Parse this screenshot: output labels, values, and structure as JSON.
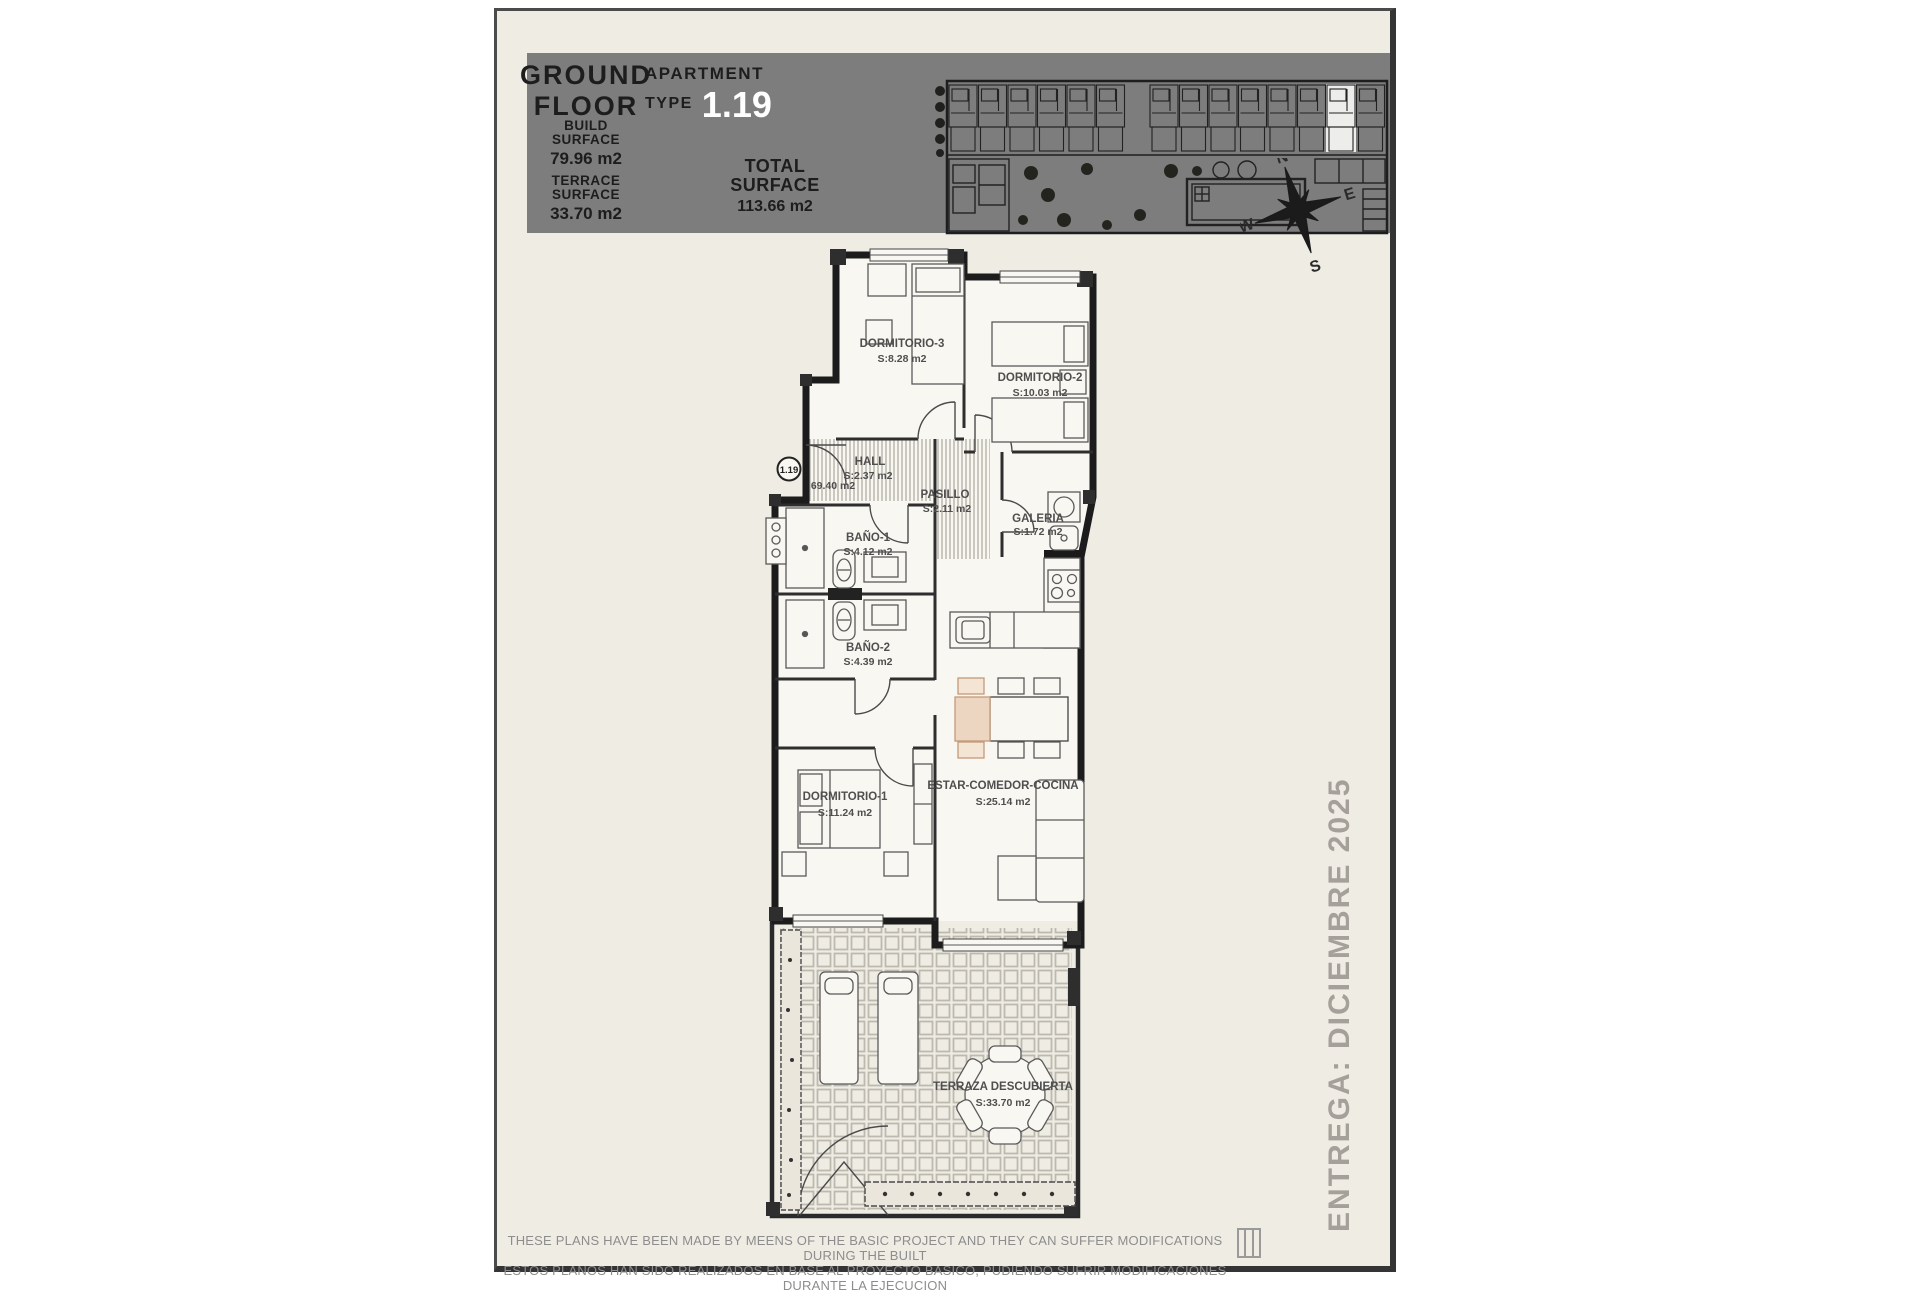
{
  "header": {
    "floor_line1": "GROUND",
    "floor_line2": "FLOOR",
    "build_label_1": "BUILD",
    "build_label_2": "SURFACE",
    "build_value": "79.96 m2",
    "terrace_label_1": "TERRACE",
    "terrace_label_2": "SURFACE",
    "terrace_value": "33.70 m2",
    "apartment_label": "APARTMENT",
    "type_label": "TYPE",
    "apartment_number": "1.19",
    "total_label_1": "TOTAL",
    "total_label_2": "SURFACE",
    "total_value": "113.66 m2"
  },
  "compass": {
    "n": "N",
    "e": "E",
    "s": "S",
    "w": "W"
  },
  "plan": {
    "unit_badge": "1.19",
    "useful_surface": "69.40 m2",
    "rooms": [
      {
        "name": "DORMITORIO-3",
        "area": "S:8.28 m2"
      },
      {
        "name": "DORMITORIO-2",
        "area": "S:10.03 m2"
      },
      {
        "name": "HALL",
        "area": "S:2.37 m2"
      },
      {
        "name": "PASILLO",
        "area": "S:2.11 m2"
      },
      {
        "name": "BAÑO-1",
        "area": "S:4.12 m2"
      },
      {
        "name": "GALERIA",
        "area": "S:1.72 m2"
      },
      {
        "name": "BAÑO-2",
        "area": "S:4.39 m2"
      },
      {
        "name": "DORMITORIO-1",
        "area": "S:11.24 m2"
      },
      {
        "name": "ESTAR-COMEDOR-COCINA",
        "area": "S:25.14 m2"
      },
      {
        "name": "TERRAZA DESCUBIERTA",
        "area": "S:33.70 m2"
      }
    ]
  },
  "site_plan": {
    "units_count": 14,
    "highlight_index": 12,
    "road_after_index": 5
  },
  "delivery_note": "ENTREGA: DICIEMBRE 2025",
  "disclaimer": {
    "line1": "THESE PLANS HAVE BEEN MADE BY MEENS OF THE BASIC PROJECT AND THEY CAN SUFFER MODIFICATIONS DURING THE BUILT",
    "line2": "ESTOS PLANOS HAN SIDO REALIZADOS EN BASE AL PROYECTO BASICO, PUDIENDO SUFRIR MODIFICACIONES DURANTE LA EJECUCION"
  },
  "colors": {
    "paper": "#efece4",
    "title_band": "#7d7d7d",
    "accent_white": "#ffffff",
    "wall": "#1c1c1c",
    "room_label": "#4f4f4f",
    "muted_gray": "#a5a19a",
    "furniture_tan": "#ecd6c2"
  }
}
